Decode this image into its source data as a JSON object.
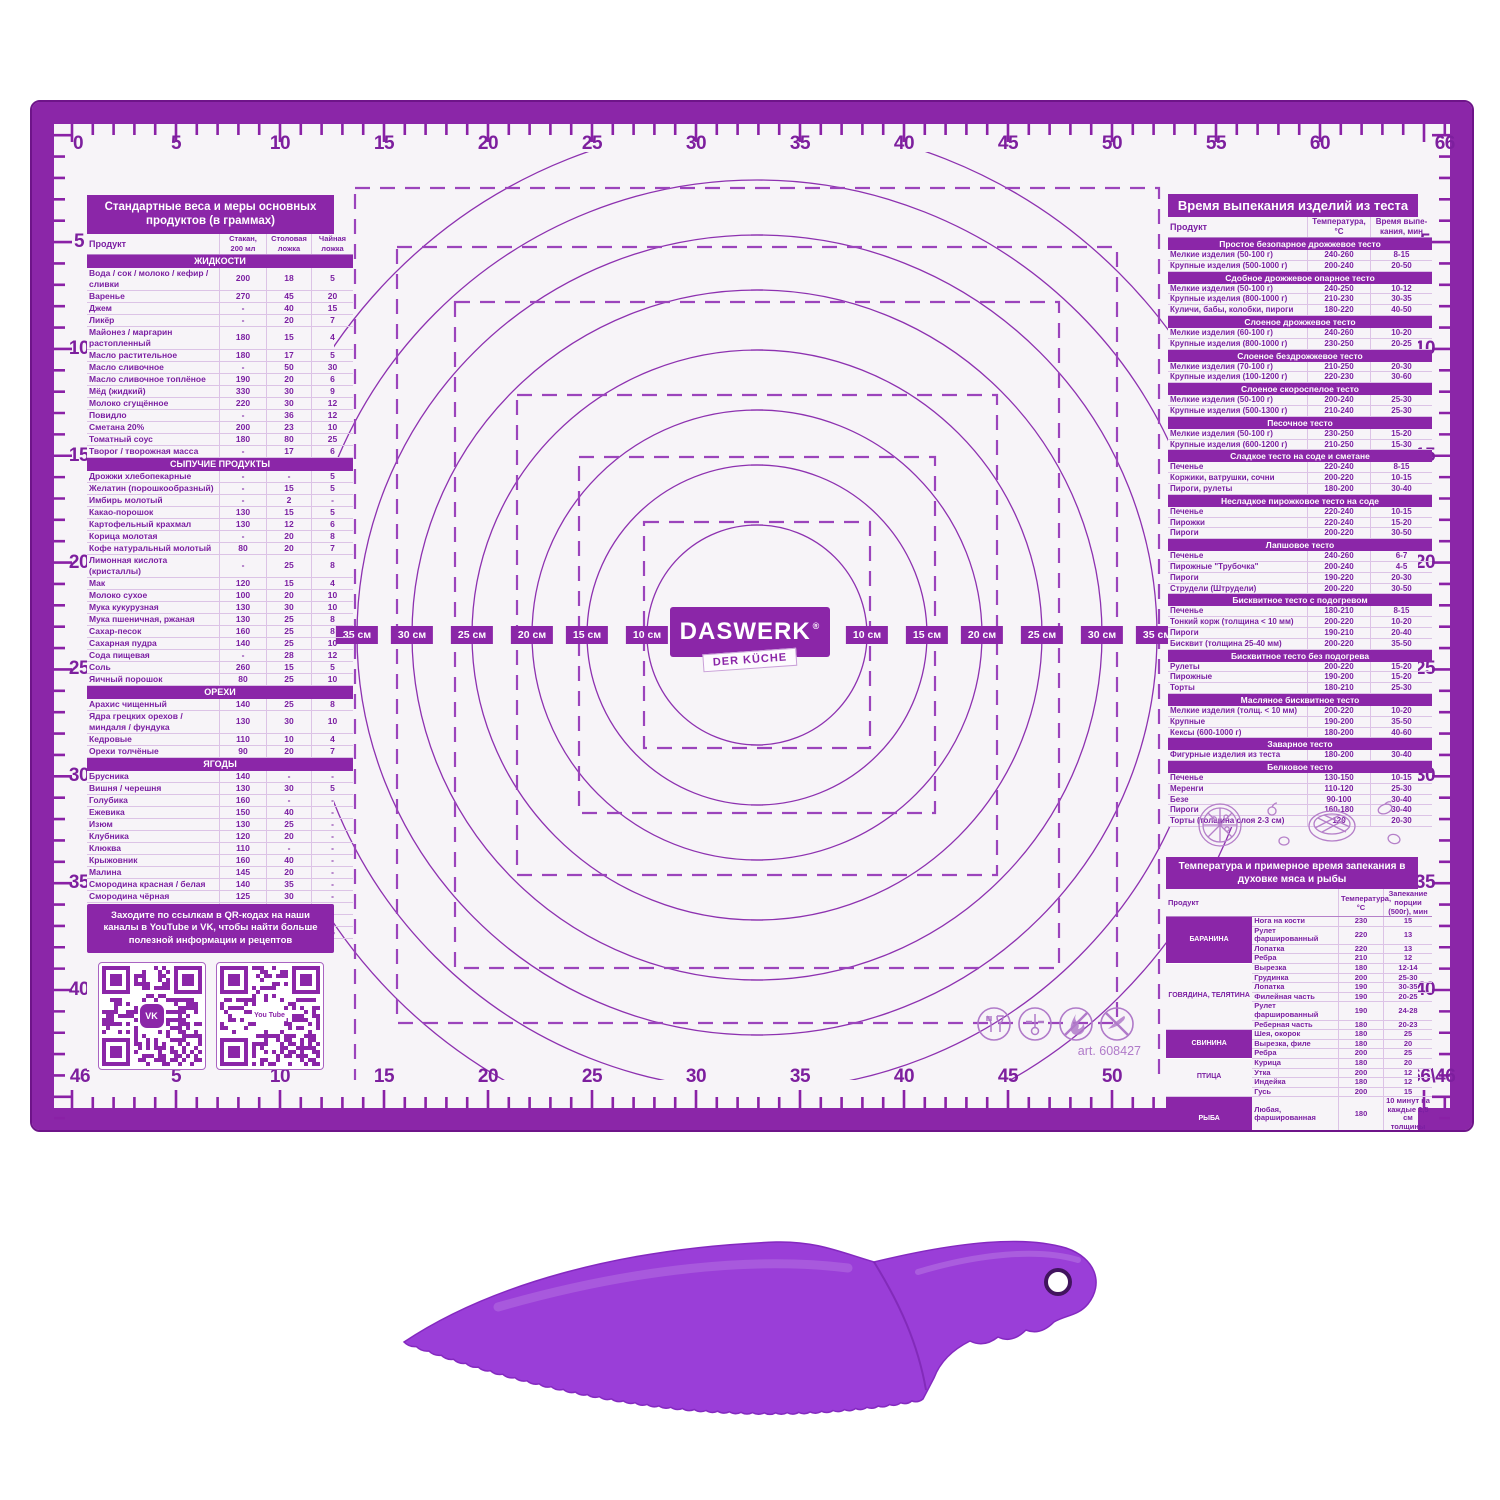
{
  "brand": {
    "logo": "DASWERK",
    "reg": "®",
    "sub": "DER KÜCHE",
    "art": "art. 608427"
  },
  "colors": {
    "primary": "#8b26a8",
    "dark_frame": "#6e1489",
    "line": "#8d31b0",
    "hairline": "#dcc3e6",
    "knife": "#9a3ed8"
  },
  "rulers": {
    "top": [
      {
        "label": "0",
        "cm": 0
      },
      {
        "label": "5",
        "cm": 5
      },
      {
        "label": "10",
        "cm": 10
      },
      {
        "label": "15",
        "cm": 15
      },
      {
        "label": "20",
        "cm": 20
      },
      {
        "label": "25",
        "cm": 25
      },
      {
        "label": "30",
        "cm": 30
      },
      {
        "label": "35",
        "cm": 35
      },
      {
        "label": "40",
        "cm": 40
      },
      {
        "label": "45",
        "cm": 45
      },
      {
        "label": "50",
        "cm": 50
      },
      {
        "label": "55",
        "cm": 55
      },
      {
        "label": "60",
        "cm": 60
      },
      {
        "label": "66",
        "cm": 66
      }
    ],
    "bottom": [
      {
        "label": "46",
        "cm": 0
      },
      {
        "label": "5",
        "cm": 5
      },
      {
        "label": "10",
        "cm": 10
      },
      {
        "label": "15",
        "cm": 15
      },
      {
        "label": "20",
        "cm": 20
      },
      {
        "label": "25",
        "cm": 25
      },
      {
        "label": "30",
        "cm": 30
      },
      {
        "label": "35",
        "cm": 35
      },
      {
        "label": "40",
        "cm": 40
      },
      {
        "label": "45",
        "cm": 45
      },
      {
        "label": "50",
        "cm": 50
      },
      {
        "label": "55",
        "cm": 55
      },
      {
        "label": "60",
        "cm": 60
      },
      {
        "label": "66\\46",
        "cm": 66
      }
    ],
    "left": [
      {
        "label": "5",
        "cm": 5
      },
      {
        "label": "10",
        "cm": 10
      },
      {
        "label": "15",
        "cm": 15
      },
      {
        "label": "20",
        "cm": 20
      },
      {
        "label": "25",
        "cm": 25
      },
      {
        "label": "30",
        "cm": 30
      },
      {
        "label": "35",
        "cm": 35
      },
      {
        "label": "40",
        "cm": 40
      }
    ],
    "right": [
      {
        "label": "5",
        "cm": 5
      },
      {
        "label": "10",
        "cm": 10
      },
      {
        "label": "15",
        "cm": 15
      },
      {
        "label": "20",
        "cm": 20
      },
      {
        "label": "25",
        "cm": 25
      },
      {
        "label": "30",
        "cm": 30
      },
      {
        "label": "35",
        "cm": 35
      },
      {
        "label": "40",
        "cm": 40
      }
    ]
  },
  "diameter_labels": {
    "left": [
      "35 см",
      "30 см",
      "25 см",
      "20 см",
      "15 см",
      "10 см"
    ],
    "right": [
      "10 см",
      "15 см",
      "20 см",
      "25 см",
      "30 см",
      "35 см"
    ]
  },
  "weights_table": {
    "title": "Стандартные веса и меры основных продуктов (в граммах)",
    "col_headers": [
      "Продукт",
      "Стакан, 200 мл",
      "Столовая ложка",
      "Чайная ложка"
    ],
    "sections": [
      {
        "name": "ЖИДКОСТИ",
        "rows": [
          [
            "Вода / сок / молоко / кефир / сливки",
            "200",
            "18",
            "5"
          ],
          [
            "Варенье",
            "270",
            "45",
            "20"
          ],
          [
            "Джем",
            "-",
            "40",
            "15"
          ],
          [
            "Ликёр",
            "-",
            "20",
            "7"
          ],
          [
            "Майонез / маргарин растопленный",
            "180",
            "15",
            "4"
          ],
          [
            "Масло растительное",
            "180",
            "17",
            "5"
          ],
          [
            "Масло сливочное",
            "-",
            "50",
            "30"
          ],
          [
            "Масло сливочное топлёное",
            "190",
            "20",
            "6"
          ],
          [
            "Мёд (жидкий)",
            "330",
            "30",
            "9"
          ],
          [
            "Молоко сгущённое",
            "220",
            "30",
            "12"
          ],
          [
            "Повидло",
            "-",
            "36",
            "12"
          ],
          [
            "Сметана 20%",
            "200",
            "23",
            "10"
          ],
          [
            "Томатный соус",
            "180",
            "80",
            "25"
          ],
          [
            "Творог / творожная масса",
            "-",
            "17",
            "6"
          ]
        ]
      },
      {
        "name": "СЫПУЧИЕ ПРОДУКТЫ",
        "rows": [
          [
            "Дрожжи хлебопекарные",
            "-",
            "-",
            "5"
          ],
          [
            "Желатин (порошкообразный)",
            "-",
            "15",
            "5"
          ],
          [
            "Имбирь молотый",
            "-",
            "2",
            "-"
          ],
          [
            "Какао-порошок",
            "130",
            "15",
            "5"
          ],
          [
            "Картофельный крахмал",
            "130",
            "12",
            "6"
          ],
          [
            "Корица молотая",
            "-",
            "20",
            "8"
          ],
          [
            "Кофе натуральный молотый",
            "80",
            "20",
            "7"
          ],
          [
            "Лимонная кислота (кристаллы)",
            "-",
            "25",
            "8"
          ],
          [
            "Мак",
            "120",
            "15",
            "4"
          ],
          [
            "Молоко сухое",
            "100",
            "20",
            "10"
          ],
          [
            "Мука кукурузная",
            "130",
            "30",
            "10"
          ],
          [
            "Мука пшеничная, ржаная",
            "130",
            "25",
            "8"
          ],
          [
            "Сахар-песок",
            "160",
            "25",
            "8"
          ],
          [
            "Сахарная пудра",
            "140",
            "25",
            "10"
          ],
          [
            "Сода пищевая",
            "-",
            "28",
            "12"
          ],
          [
            "Соль",
            "260",
            "15",
            "5"
          ],
          [
            "Яичный порошок",
            "80",
            "25",
            "10"
          ]
        ]
      },
      {
        "name": "ОРЕХИ",
        "rows": [
          [
            "Арахис чищенный",
            "140",
            "25",
            "8"
          ],
          [
            "Ядра грецких орехов / миндаля / фундука",
            "130",
            "30",
            "10"
          ],
          [
            "Кедровые",
            "110",
            "10",
            "4"
          ],
          [
            "Орехи толчёные",
            "90",
            "20",
            "7"
          ]
        ]
      },
      {
        "name": "ЯГОДЫ",
        "rows": [
          [
            "Брусника",
            "140",
            "-",
            "-"
          ],
          [
            "Вишня / черешня",
            "130",
            "30",
            "5"
          ],
          [
            "Голубика",
            "160",
            "-",
            "-"
          ],
          [
            "Ежевика",
            "150",
            "40",
            "-"
          ],
          [
            "Изюм",
            "130",
            "25",
            "-"
          ],
          [
            "Клубника",
            "120",
            "20",
            "-"
          ],
          [
            "Клюква",
            "110",
            "-",
            "-"
          ],
          [
            "Крыжовник",
            "160",
            "40",
            "-"
          ],
          [
            "Малина",
            "145",
            "20",
            "-"
          ],
          [
            "Смородина красная / белая",
            "140",
            "35",
            "-"
          ],
          [
            "Смородина чёрная",
            "125",
            "30",
            "-"
          ],
          [
            "Черника",
            "160",
            "-",
            "-"
          ],
          [
            "Шелковица",
            "135",
            "40",
            "-"
          ],
          [
            "Шиповник засушенный",
            "-",
            "20",
            "6"
          ]
        ]
      }
    ]
  },
  "qr_panel": {
    "text": "Заходите по ссылкам в QR-кодах на наши каналы в YouTube и VK, чтобы найти больше полезной информации и рецептов",
    "qr1_label": "VK",
    "qr2_label": "You Tube"
  },
  "baking_table": {
    "title": "Время выпекания изделий из теста",
    "col_headers": [
      "Продукт",
      "Температура, °С",
      "Время выпе- кания, мин"
    ],
    "sections": [
      {
        "name": "Простое безопарное дрожжевое тесто",
        "rows": [
          [
            "Мелкие изделия (50-100 г)",
            "240-260",
            "8-15"
          ],
          [
            "Крупные изделия (500-1000 г)",
            "200-240",
            "20-50"
          ]
        ]
      },
      {
        "name": "Сдобное дрожжевое опарное тесто",
        "rows": [
          [
            "Мелкие изделия (50-100 г)",
            "240-250",
            "10-12"
          ],
          [
            "Крупные изделия (800-1000 г)",
            "210-230",
            "30-35"
          ],
          [
            "Куличи, бабы, колобки, пироги",
            "180-220",
            "40-50"
          ]
        ]
      },
      {
        "name": "Слоеное дрожжевое тесто",
        "rows": [
          [
            "Мелкие изделия (60-100 г)",
            "240-260",
            "10-20"
          ],
          [
            "Крупные изделия (800-1000 г)",
            "230-250",
            "20-25"
          ]
        ]
      },
      {
        "name": "Слоеное бездрожжевое тесто",
        "rows": [
          [
            "Мелкие изделия (70-100 г)",
            "210-250",
            "20-30"
          ],
          [
            "Крупные изделия (100-1200 г)",
            "220-230",
            "30-60"
          ]
        ]
      },
      {
        "name": "Слоеное скороспелое тесто",
        "rows": [
          [
            "Мелкие изделия (50-100 г)",
            "200-240",
            "25-30"
          ],
          [
            "Крупные изделия (500-1300 г)",
            "210-240",
            "25-30"
          ]
        ]
      },
      {
        "name": "Песочное тесто",
        "rows": [
          [
            "Мелкие изделия (50-100 г)",
            "230-250",
            "15-20"
          ],
          [
            "Крупные изделия (600-1200 г)",
            "210-250",
            "15-30"
          ]
        ]
      },
      {
        "name": "Сладкое тесто на соде и сметане",
        "rows": [
          [
            "Печенье",
            "220-240",
            "8-15"
          ],
          [
            "Коржики, ватрушки, сочни",
            "200-220",
            "10-15"
          ],
          [
            "Пироги, рулеты",
            "180-200",
            "30-40"
          ]
        ]
      },
      {
        "name": "Несладкое пирожковое тесто на соде",
        "rows": [
          [
            "Печенье",
            "220-240",
            "10-15"
          ],
          [
            "Пирожки",
            "220-240",
            "15-20"
          ],
          [
            "Пироги",
            "200-220",
            "30-50"
          ]
        ]
      },
      {
        "name": "Лапшовое тесто",
        "rows": [
          [
            "Печенье",
            "240-260",
            "6-7"
          ],
          [
            "Пирожные \"Трубочка\"",
            "200-240",
            "4-5"
          ],
          [
            "Пироги",
            "190-220",
            "20-30"
          ],
          [
            "Струдели (Штрудели)",
            "200-220",
            "30-50"
          ]
        ]
      },
      {
        "name": "Бисквитное тесто с подогревом",
        "rows": [
          [
            "Печенье",
            "180-210",
            "8-15"
          ],
          [
            "Тонкий корж (толщина < 10 мм)",
            "200-220",
            "10-20"
          ],
          [
            "Пироги",
            "190-210",
            "20-40"
          ],
          [
            "Бисквит (толщина 25-40 мм)",
            "200-220",
            "35-50"
          ]
        ]
      },
      {
        "name": "Бисквитное тесто без подогрева",
        "rows": [
          [
            "Рулеты",
            "200-220",
            "15-20"
          ],
          [
            "Пирожные",
            "190-200",
            "15-20"
          ],
          [
            "Торты",
            "180-210",
            "25-30"
          ]
        ]
      },
      {
        "name": "Масляное бисквитное тесто",
        "rows": [
          [
            "Мелкие изделия (толщ. < 10 мм)",
            "200-220",
            "10-20"
          ],
          [
            "Крупные",
            "190-200",
            "35-50"
          ],
          [
            "Кексы (600-1000 г)",
            "180-200",
            "40-60"
          ]
        ]
      },
      {
        "name": "Заварное тесто",
        "rows": [
          [
            "Фигурные изделия из теста",
            "180-200",
            "30-40"
          ]
        ]
      },
      {
        "name": "Белковое тесто",
        "rows": [
          [
            "Печенье",
            "130-150",
            "10-15"
          ],
          [
            "Меренги",
            "110-120",
            "25-30"
          ],
          [
            "Безе",
            "90-100",
            "30-40"
          ],
          [
            "Пироги",
            "160-180",
            "30-40"
          ],
          [
            "Торты (толщина слоя 2-3 см)",
            "120",
            "20-30"
          ]
        ]
      }
    ]
  },
  "meat_table": {
    "title": "Температура и примерное время запекания в духовке мяса и рыбы",
    "col_headers": [
      "Продукт",
      "Температура, °С",
      "Запекание порции (500г), мин"
    ],
    "groups": [
      {
        "name": "БАРАНИНА",
        "rows": [
          [
            "Нога на кости",
            "230",
            "15"
          ],
          [
            "Рулет фаршированный",
            "220",
            "13"
          ],
          [
            "Лопатка",
            "220",
            "13"
          ],
          [
            "Ребра",
            "210",
            "12"
          ]
        ]
      },
      {
        "name": "ГОВЯДИНА, ТЕЛЯТИНА",
        "rows": [
          [
            "Вырезка",
            "180",
            "12-14"
          ],
          [
            "Грудинка",
            "200",
            "25-30"
          ],
          [
            "Лопатка",
            "190",
            "30-35"
          ],
          [
            "Филейная часть",
            "190",
            "20-25"
          ],
          [
            "Рулет фаршированный",
            "190",
            "24-28"
          ],
          [
            "Реберная часть",
            "180",
            "20-23"
          ]
        ]
      },
      {
        "name": "СВИНИНА",
        "rows": [
          [
            "Шея, окорок",
            "180",
            "25"
          ],
          [
            "Вырезка, филе",
            "180",
            "20"
          ],
          [
            "Ребра",
            "200",
            "25"
          ]
        ]
      },
      {
        "name": "ПТИЦА",
        "rows": [
          [
            "Курица",
            "180",
            "20"
          ],
          [
            "Утка",
            "200",
            "12"
          ],
          [
            "Индейка",
            "180",
            "12"
          ],
          [
            "Гусь",
            "200",
            "15"
          ]
        ]
      },
      {
        "name": "РЫБА",
        "rows": [
          [
            "Любая, фаршированная",
            "180",
            "10 минут на каждые 2,5 см толщины"
          ],
          [
            "Рыба целиком",
            "180",
            "25-30"
          ]
        ]
      }
    ]
  }
}
